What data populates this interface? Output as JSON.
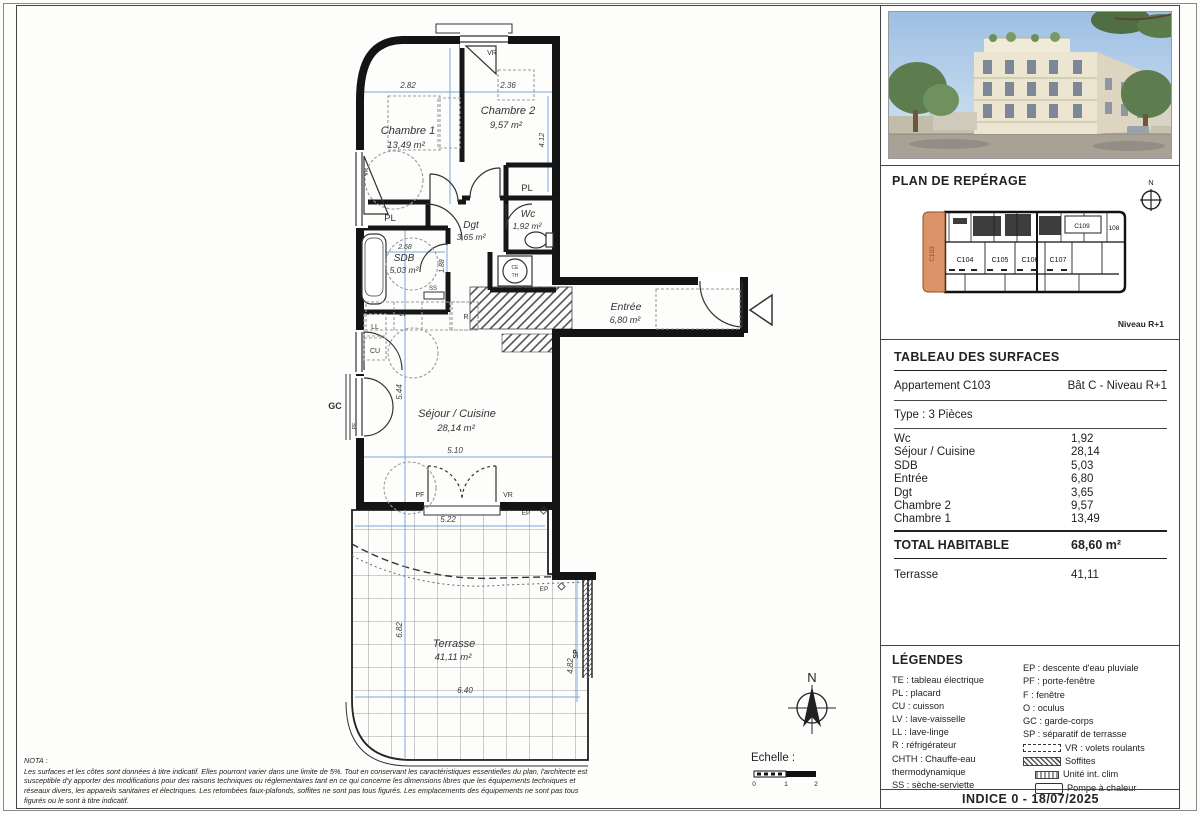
{
  "plan": {
    "rooms": {
      "chambre1": {
        "name": "Chambre 1",
        "area": "13,49 m²"
      },
      "chambre2": {
        "name": "Chambre 2",
        "area": "9,57 m²"
      },
      "dgt": {
        "name": "Dgt",
        "area": "3,65 m²"
      },
      "wc": {
        "name": "Wc",
        "area": "1,92 m²"
      },
      "sdb": {
        "name": "SDB",
        "area": "5,03 m²"
      },
      "entree": {
        "name": "Entrée",
        "area": "6,80 m²"
      },
      "sejour": {
        "name": "Séjour / Cuisine",
        "area": "28,14 m²"
      },
      "terrasse": {
        "name": "Terrasse",
        "area": "41,11 m²"
      }
    },
    "dims": {
      "chambre1_w": "2.82",
      "chambre2_w": "2.36",
      "chambre2_h": "4.12",
      "sdb_w": "2.68",
      "sdb_h": "1.88",
      "sejour_h": "5.44",
      "sejour_w": "5.10",
      "terrasse_top": "5.22",
      "terrasse_left": "6.82",
      "terrasse_bottom": "6.40",
      "terrasse_right": "4.82"
    },
    "tags": {
      "pl": "PL",
      "vr": "VR",
      "pf": "PF",
      "gc": "GC",
      "ll": "LL",
      "cu": "CU",
      "lv": "LV",
      "r": "R",
      "ss": "SS",
      "ep": "EP",
      "sp": "SP",
      "ce": "CE",
      "th": "TH"
    },
    "north_label": "N",
    "echelle": {
      "label": "Echelle :",
      "tick0": "0",
      "tick1": "1",
      "tick2": "2"
    },
    "nota": {
      "title": "NOTA :",
      "lines": [
        "Les surfaces et les côtes sont données à titre indicatif. Elles pourront varier dans une limite de 5%. Tout en conservant les caractéristiques essentielles du plan, l'architecte est",
        "susceptible d'y apporter des modifications pour des raisons techniques ou réglementaires tant en ce qui concerne les dimensions libres que les équipements techniques et",
        "réseaux divers, les appareils sanitaires et électriques. Les retombées faux-plafonds, soffites ne sont pas tous figurés. Les emplacements des équipements ne sont pas tous",
        "figurés ou le sont à titre indicatif."
      ]
    }
  },
  "sidebar": {
    "reperage": {
      "title": "PLAN DE REPÉRAGE",
      "unit_highlight": "C103",
      "units": [
        "C104",
        "C105",
        "C106",
        "C107"
      ],
      "units_top": [
        "C109",
        "108"
      ],
      "level": "Niveau R+1",
      "north_label": "N"
    },
    "surfaces": {
      "title": "TABLEAU DES SURFACES",
      "apartment": "Appartement C103",
      "building": "Bât C - Niveau R+1",
      "type": "Type : 3 Pièces",
      "rows": [
        {
          "label": "Wc",
          "value": "1,92"
        },
        {
          "label": "Séjour / Cuisine",
          "value": "28,14"
        },
        {
          "label": "SDB",
          "value": "5,03"
        },
        {
          "label": "Entrée",
          "value": "6,80"
        },
        {
          "label": "Dgt",
          "value": "3,65"
        },
        {
          "label": "Chambre 2",
          "value": "9,57"
        },
        {
          "label": "Chambre 1",
          "value": "13,49"
        }
      ],
      "total_label": "TOTAL HABITABLE",
      "total_value": "68,60 m²",
      "extra_label": "Terrasse",
      "extra_value": "41,11"
    },
    "legends": {
      "title": "LÉGENDES",
      "left": [
        "TE : tableau électrique",
        "PL : placard",
        "CU : cuisson",
        "LV : lave-vaisselle",
        "LL : lave-linge",
        "R : réfrigérateur",
        "CHTH : Chauffe-eau",
        "thermodynamique",
        "SS : sèche-serviette"
      ],
      "right": [
        "EP : descente d'eau pluviale",
        "PF : porte-fenêtre",
        "F : fenêtre",
        "O : oculus",
        "GC : garde-corps",
        "SP : séparatif de terrasse"
      ],
      "symbols": [
        {
          "label": "VR : volets roulants"
        },
        {
          "label": "Soffites"
        },
        {
          "label": "Unité int. clim"
        },
        {
          "label": "Pompe à chaleur"
        }
      ]
    },
    "indice": "INDICE 0 - 18/07/2025"
  }
}
